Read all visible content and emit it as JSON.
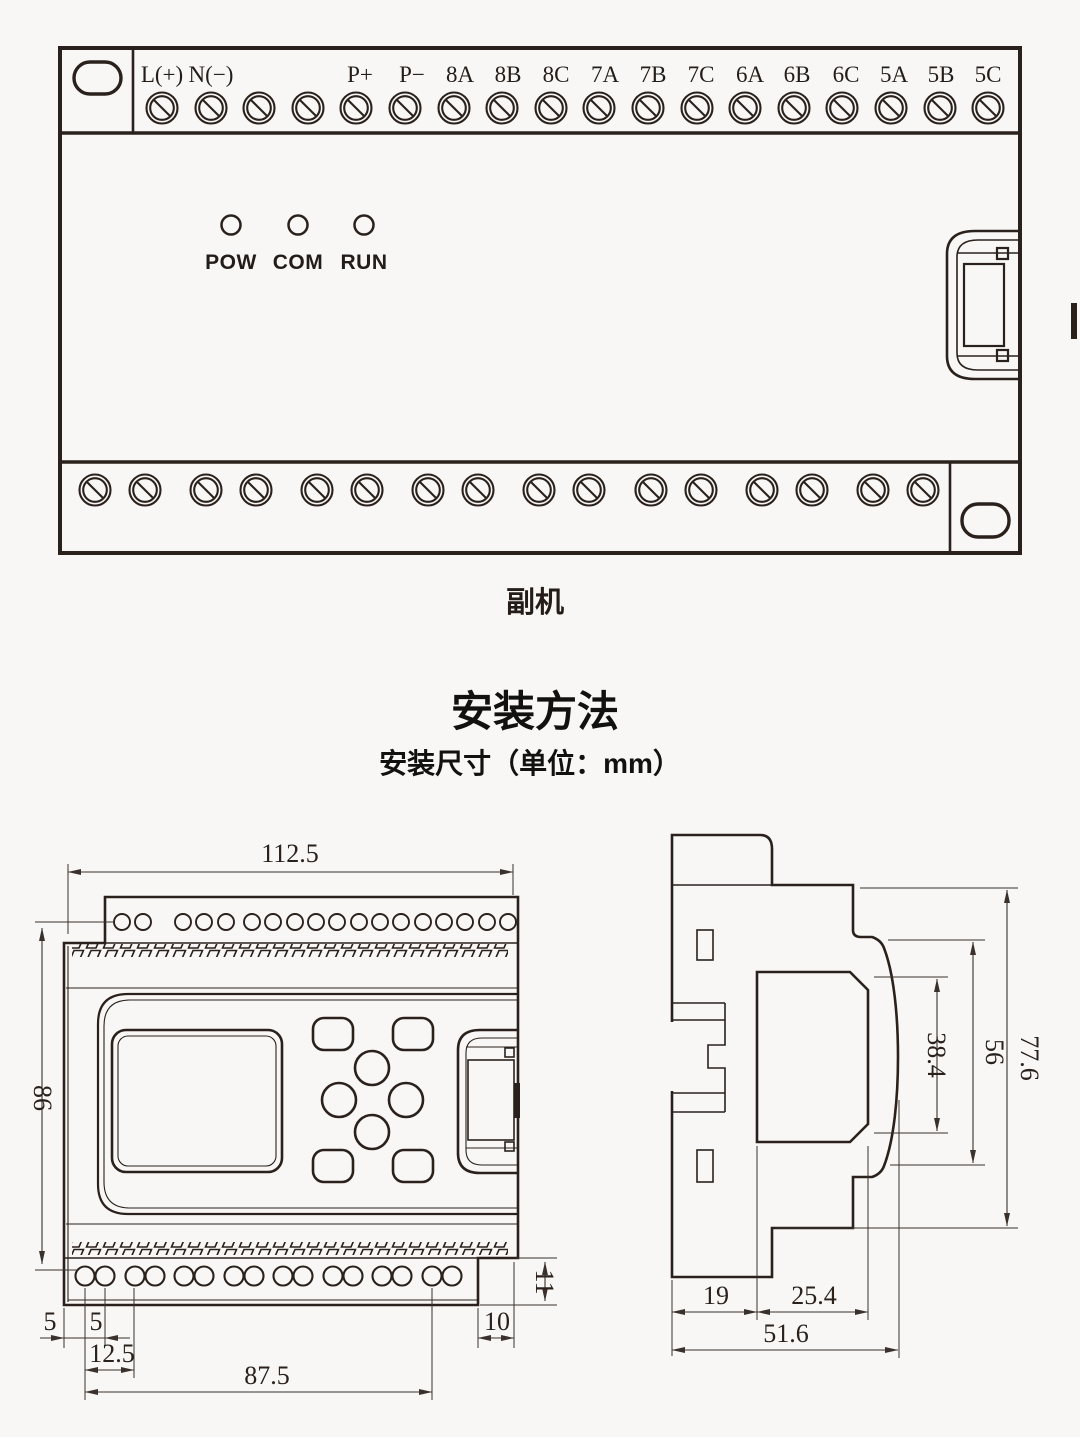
{
  "top_device": {
    "caption": "副机",
    "terminals": [
      "L(+)",
      "N(−)",
      "",
      "",
      "P+",
      "P−",
      "8A",
      "8B",
      "8C",
      "7A",
      "7B",
      "7C",
      "6A",
      "6B",
      "6C",
      "5A",
      "5B",
      "5C"
    ],
    "leds": [
      "POW",
      "COM",
      "RUN"
    ]
  },
  "section": {
    "title": "安装方法",
    "subtitle": "安装尺寸（单位：mm）"
  },
  "front_view": {
    "dims": {
      "width": "112.5",
      "height": "86",
      "edge_offset": "5",
      "hole_pitch": "5",
      "pair_pitch": "12.5",
      "hole_span": "87.5",
      "notch_width": "10",
      "notch_height": "11"
    }
  },
  "side_view": {
    "dims": {
      "panel_height": "38.4",
      "face_height": "56",
      "total_height": "77.6",
      "back_depth": "19",
      "mid_depth": "25.4",
      "total_depth": "51.6"
    }
  },
  "colors": {
    "line": "#2a211c",
    "background": "#f8f7f5"
  }
}
